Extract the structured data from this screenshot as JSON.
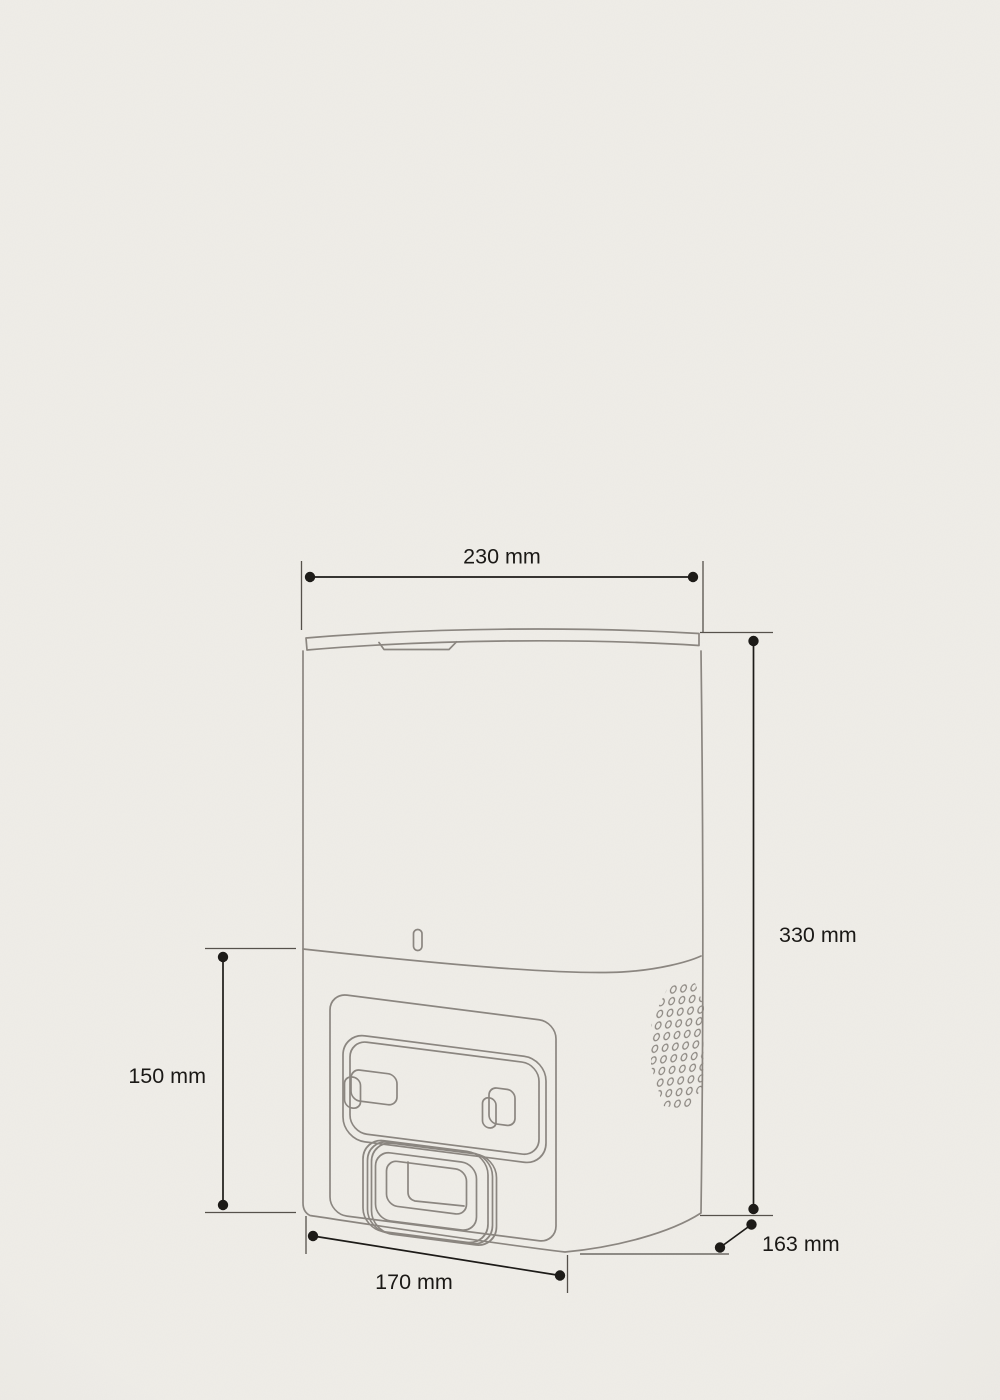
{
  "figure": {
    "kind": "technical-dimension-drawing",
    "subject": "robot-vacuum-auto-empty-dock-line-drawing",
    "unit": "mm"
  },
  "dimensions": {
    "top_width": {
      "label": "230 mm",
      "value": 230,
      "unit": "mm",
      "position": "top-horizontal"
    },
    "height": {
      "label": "330 mm",
      "value": 330,
      "unit": "mm",
      "position": "right-vertical"
    },
    "base_height": {
      "label": "150 mm",
      "value": 150,
      "unit": "mm",
      "position": "left-vertical"
    },
    "base_width": {
      "label": "170 mm",
      "value": 170,
      "unit": "mm",
      "position": "bottom-horizontal"
    },
    "base_depth": {
      "label": "163 mm",
      "value": 163,
      "unit": "mm",
      "position": "bottom-right-diagonal"
    }
  },
  "colors": {
    "background": "#efede8",
    "device_outline": "#8b8680",
    "dimension_lines": "#1d1b18",
    "extension_lines": "#56514b",
    "label_text": "#1b1916"
  }
}
